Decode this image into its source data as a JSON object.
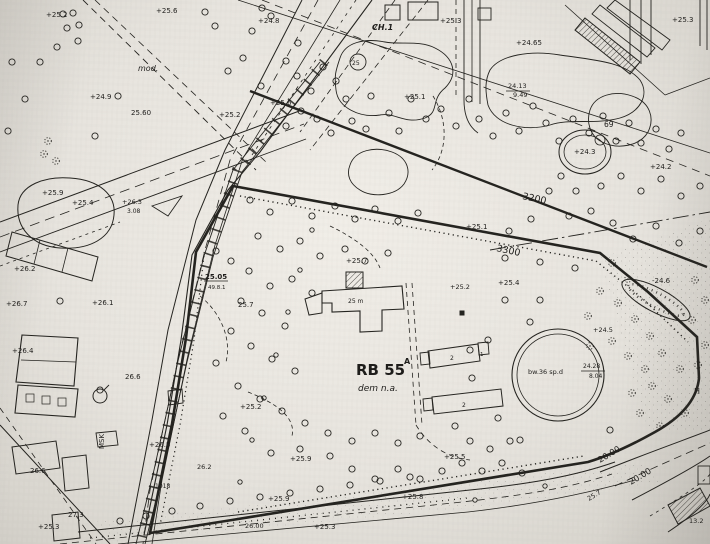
{
  "map": {
    "type": "scanned-cadastral-site-plan",
    "ink_color": "#24231f",
    "paper_color": "#e9e6e0",
    "parcel_annotation": {
      "id": "RB 55",
      "superscript": "A",
      "note": "dem n.a."
    },
    "round_feature_text": "bw.36 sp.d",
    "labels": [
      {
        "t": "+25.2",
        "x": 46,
        "y": 17,
        "s": 7
      },
      {
        "t": "+25.6",
        "x": 156,
        "y": 13,
        "s": 7
      },
      {
        "t": "+24.8",
        "x": 258,
        "y": 23,
        "s": 7
      },
      {
        "t": "+25.3",
        "x": 440,
        "y": 23,
        "s": 7
      },
      {
        "t": "CH.1",
        "x": 372,
        "y": 30,
        "s": 8,
        "f": "ib"
      },
      {
        "t": "+25.3",
        "x": 672,
        "y": 22,
        "s": 7
      },
      {
        "t": "mod.",
        "x": 138,
        "y": 71,
        "s": 8,
        "f": "i"
      },
      {
        "t": "+24.9",
        "x": 90,
        "y": 99,
        "s": 7
      },
      {
        "t": "25.60",
        "x": 131,
        "y": 115,
        "s": 7
      },
      {
        "t": "+25.6",
        "x": 270,
        "y": 105,
        "s": 7
      },
      {
        "t": "+25.2",
        "x": 219,
        "y": 117,
        "s": 7
      },
      {
        "t": "+24.65",
        "x": 516,
        "y": 45,
        "s": 7
      },
      {
        "t": "24.13",
        "x": 508,
        "y": 88,
        "s": 6.5
      },
      {
        "t": "9.49",
        "x": 513,
        "y": 97,
        "s": 6.5
      },
      {
        "t": "69",
        "x": 604,
        "y": 127,
        "s": 7.5
      },
      {
        "t": "+24.3",
        "x": 574,
        "y": 154,
        "s": 7
      },
      {
        "t": "+24.2",
        "x": 650,
        "y": 169,
        "s": 7
      },
      {
        "t": "3200",
        "x": 522,
        "y": 199,
        "s": 9.5,
        "r": 12
      },
      {
        "t": "3300",
        "x": 496,
        "y": 251,
        "s": 9.5,
        "r": 12
      },
      {
        "t": "+25.1",
        "x": 466,
        "y": 229,
        "s": 7
      },
      {
        "t": "+25.1",
        "x": 404,
        "y": 99,
        "s": 7
      },
      {
        "t": "-24.6",
        "x": 652,
        "y": 283,
        "s": 7
      },
      {
        "t": "+25.9",
        "x": 42,
        "y": 195,
        "s": 7
      },
      {
        "t": "+25.4",
        "x": 72,
        "y": 205,
        "s": 7
      },
      {
        "t": "+26.3",
        "x": 122,
        "y": 204,
        "s": 6.5
      },
      {
        "t": "3.08",
        "x": 127,
        "y": 213,
        "s": 6
      },
      {
        "t": "+26.2",
        "x": 14,
        "y": 271,
        "s": 7
      },
      {
        "t": "+26.7",
        "x": 6,
        "y": 306,
        "s": 7
      },
      {
        "t": "+26.1",
        "x": 92,
        "y": 305,
        "s": 7
      },
      {
        "t": "25.05",
        "x": 205,
        "y": 279,
        "s": 7,
        "f": "b"
      },
      {
        "t": "49.8.1",
        "x": 208,
        "y": 289,
        "s": 5.5
      },
      {
        "t": "25.7",
        "x": 238,
        "y": 307,
        "s": 7
      },
      {
        "t": "+25.7",
        "x": 346,
        "y": 263,
        "s": 7
      },
      {
        "t": "+25.4",
        "x": 498,
        "y": 285,
        "s": 7
      },
      {
        "t": "+25.2",
        "x": 450,
        "y": 289,
        "s": 6.5
      },
      {
        "t": "RB 55",
        "x": 356,
        "y": 375,
        "s": 15,
        "f": "b"
      },
      {
        "t": "A",
        "x": 404,
        "y": 364,
        "s": 8,
        "f": "b"
      },
      {
        "t": "dem n.a.",
        "x": 358,
        "y": 391,
        "s": 9,
        "f": "i"
      },
      {
        "t": "bw.36 sp.d",
        "x": 528,
        "y": 374,
        "s": 6.5
      },
      {
        "t": "24.28",
        "x": 583,
        "y": 368,
        "s": 6
      },
      {
        "t": "8.04",
        "x": 589,
        "y": 378,
        "s": 6
      },
      {
        "t": "+24.5",
        "x": 593,
        "y": 332,
        "s": 6.5
      },
      {
        "t": "+26.4",
        "x": 12,
        "y": 353,
        "s": 7
      },
      {
        "t": "26.6",
        "x": 125,
        "y": 379,
        "s": 7
      },
      {
        "t": "MSK",
        "x": 104,
        "y": 449,
        "s": 7,
        "r": -90
      },
      {
        "t": "+26.5",
        "x": 149,
        "y": 447,
        "s": 7
      },
      {
        "t": "26.6",
        "x": 30,
        "y": 473,
        "s": 7
      },
      {
        "t": "27.3",
        "x": 68,
        "y": 517,
        "s": 7
      },
      {
        "t": "+25.3",
        "x": 38,
        "y": 529,
        "s": 7
      },
      {
        "t": "26.2",
        "x": 197,
        "y": 469,
        "s": 6.5
      },
      {
        "t": "1018",
        "x": 155,
        "y": 488,
        "s": 6
      },
      {
        "t": "+25.9",
        "x": 290,
        "y": 461,
        "s": 7
      },
      {
        "t": "+25.5",
        "x": 444,
        "y": 459,
        "s": 7
      },
      {
        "t": "+25.9",
        "x": 268,
        "y": 501,
        "s": 7
      },
      {
        "t": "+25.8",
        "x": 402,
        "y": 499,
        "s": 7
      },
      {
        "t": "+25.3",
        "x": 314,
        "y": 529,
        "s": 7
      },
      {
        "t": "26.00",
        "x": 245,
        "y": 528,
        "s": 6.5
      },
      {
        "t": "+25.2",
        "x": 240,
        "y": 409,
        "s": 7
      },
      {
        "t": "20.00",
        "x": 600,
        "y": 463,
        "s": 8.5,
        "r": -31
      },
      {
        "t": "20.00",
        "x": 631,
        "y": 485,
        "s": 8.5,
        "r": -31
      },
      {
        "t": "25.7",
        "x": 589,
        "y": 501,
        "s": 6.5,
        "r": -31
      },
      {
        "t": "13.2",
        "x": 689,
        "y": 523,
        "s": 6.5
      },
      {
        "t": "H",
        "x": 694,
        "y": 394,
        "s": 8
      },
      {
        "t": "2",
        "x": 450,
        "y": 360,
        "s": 6
      },
      {
        "t": "2",
        "x": 462,
        "y": 407,
        "s": 6
      },
      {
        "t": "1",
        "x": 480,
        "y": 356,
        "s": 5.5
      },
      {
        "t": "25",
        "x": 352,
        "y": 65,
        "s": 6
      },
      {
        "t": "25 m",
        "x": 348,
        "y": 303,
        "s": 6
      }
    ],
    "trees": [
      [
        63,
        14
      ],
      [
        73,
        13
      ],
      [
        79,
        25
      ],
      [
        67,
        28
      ],
      [
        78,
        41
      ],
      [
        57,
        47
      ],
      [
        40,
        62
      ],
      [
        12,
        62
      ],
      [
        25,
        99
      ],
      [
        8,
        131
      ],
      [
        95,
        136
      ],
      [
        118,
        96
      ],
      [
        205,
        12
      ],
      [
        215,
        26
      ],
      [
        252,
        31
      ],
      [
        262,
        8
      ],
      [
        271,
        16
      ],
      [
        243,
        58
      ],
      [
        228,
        71
      ],
      [
        261,
        86
      ],
      [
        286,
        61
      ],
      [
        298,
        43
      ],
      [
        297,
        76
      ],
      [
        311,
        91
      ],
      [
        323,
        67
      ],
      [
        336,
        81
      ],
      [
        301,
        111
      ],
      [
        286,
        126
      ],
      [
        317,
        119
      ],
      [
        331,
        133
      ],
      [
        352,
        121
      ],
      [
        346,
        99
      ],
      [
        371,
        96
      ],
      [
        366,
        129
      ],
      [
        389,
        113
      ],
      [
        399,
        131
      ],
      [
        411,
        99
      ],
      [
        426,
        119
      ],
      [
        441,
        109
      ],
      [
        456,
        126
      ],
      [
        469,
        99
      ],
      [
        479,
        119
      ],
      [
        493,
        136
      ],
      [
        506,
        113
      ],
      [
        519,
        131
      ],
      [
        533,
        106
      ],
      [
        546,
        123
      ],
      [
        559,
        141
      ],
      [
        573,
        119
      ],
      [
        589,
        133
      ],
      [
        603,
        116
      ],
      [
        616,
        141
      ],
      [
        629,
        123
      ],
      [
        641,
        143
      ],
      [
        656,
        129
      ],
      [
        669,
        149
      ],
      [
        681,
        133
      ],
      [
        561,
        176
      ],
      [
        576,
        191
      ],
      [
        549,
        191
      ],
      [
        601,
        186
      ],
      [
        621,
        176
      ],
      [
        641,
        191
      ],
      [
        661,
        179
      ],
      [
        681,
        196
      ],
      [
        700,
        186
      ],
      [
        591,
        211
      ],
      [
        613,
        223
      ],
      [
        569,
        216
      ],
      [
        633,
        239
      ],
      [
        656,
        226
      ],
      [
        679,
        243
      ],
      [
        700,
        231
      ],
      [
        531,
        219
      ],
      [
        509,
        231
      ],
      [
        250,
        200
      ],
      [
        270,
        212
      ],
      [
        292,
        201
      ],
      [
        312,
        216
      ],
      [
        335,
        206
      ],
      [
        355,
        219
      ],
      [
        375,
        209
      ],
      [
        398,
        221
      ],
      [
        418,
        213
      ],
      [
        258,
        236
      ],
      [
        280,
        249
      ],
      [
        300,
        241
      ],
      [
        320,
        256
      ],
      [
        345,
        249
      ],
      [
        365,
        261
      ],
      [
        388,
        253
      ],
      [
        249,
        271
      ],
      [
        231,
        261
      ],
      [
        216,
        251
      ],
      [
        270,
        286
      ],
      [
        292,
        279
      ],
      [
        312,
        293
      ],
      [
        241,
        301
      ],
      [
        262,
        313
      ],
      [
        285,
        326
      ],
      [
        231,
        331
      ],
      [
        251,
        346
      ],
      [
        272,
        359
      ],
      [
        295,
        371
      ],
      [
        216,
        363
      ],
      [
        238,
        386
      ],
      [
        260,
        399
      ],
      [
        282,
        411
      ],
      [
        305,
        423
      ],
      [
        223,
        416
      ],
      [
        245,
        431
      ],
      [
        328,
        433
      ],
      [
        352,
        441
      ],
      [
        375,
        433
      ],
      [
        398,
        443
      ],
      [
        420,
        436
      ],
      [
        330,
        456
      ],
      [
        300,
        449
      ],
      [
        271,
        453
      ],
      [
        352,
        469
      ],
      [
        375,
        479
      ],
      [
        398,
        469
      ],
      [
        420,
        479
      ],
      [
        442,
        471
      ],
      [
        462,
        463
      ],
      [
        482,
        471
      ],
      [
        502,
        463
      ],
      [
        522,
        473
      ],
      [
        470,
        441
      ],
      [
        490,
        449
      ],
      [
        510,
        441
      ],
      [
        455,
        426
      ],
      [
        505,
        300
      ],
      [
        530,
        322
      ],
      [
        488,
        340
      ],
      [
        472,
        378
      ],
      [
        498,
        418
      ],
      [
        520,
        440
      ],
      [
        610,
        430
      ],
      [
        540,
        300
      ],
      [
        470,
        350
      ],
      [
        505,
        258
      ],
      [
        540,
        262
      ],
      [
        575,
        268
      ],
      [
        120,
        521
      ],
      [
        146,
        516
      ],
      [
        172,
        511
      ],
      [
        200,
        506
      ],
      [
        230,
        501
      ],
      [
        260,
        497
      ],
      [
        290,
        493
      ],
      [
        320,
        489
      ],
      [
        350,
        485
      ],
      [
        380,
        481
      ],
      [
        410,
        477
      ],
      [
        60,
        301
      ],
      [
        100,
        390
      ]
    ],
    "dotted_trees": [
      [
        48,
        141
      ],
      [
        44,
        154
      ],
      [
        56,
        161
      ],
      [
        612,
        263
      ],
      [
        628,
        279
      ],
      [
        600,
        291
      ],
      [
        618,
        303
      ],
      [
        588,
        316
      ],
      [
        635,
        319
      ],
      [
        650,
        336
      ],
      [
        612,
        341
      ],
      [
        590,
        346
      ],
      [
        628,
        356
      ],
      [
        645,
        369
      ],
      [
        662,
        353
      ],
      [
        680,
        369
      ],
      [
        652,
        386
      ],
      [
        668,
        399
      ],
      [
        632,
        393
      ],
      [
        685,
        413
      ],
      [
        640,
        413
      ],
      [
        660,
        426
      ],
      [
        695,
        280
      ],
      [
        705,
        300
      ],
      [
        692,
        320
      ],
      [
        705,
        345
      ],
      [
        698,
        365
      ]
    ],
    "manholes": [
      [
        312,
        230
      ],
      [
        300,
        270
      ],
      [
        288,
        312
      ],
      [
        276,
        355
      ],
      [
        264,
        398
      ],
      [
        252,
        440
      ],
      [
        240,
        482
      ],
      [
        475,
        500
      ],
      [
        545,
        486
      ]
    ],
    "filled_squares": [
      [
        462,
        313
      ]
    ]
  }
}
